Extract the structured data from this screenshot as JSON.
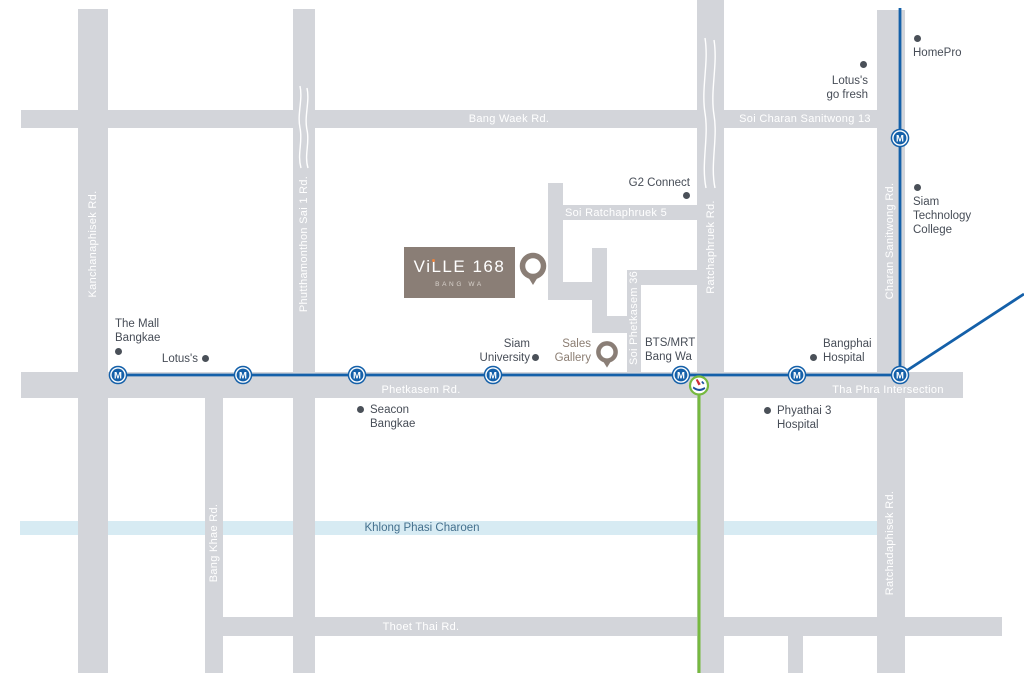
{
  "colors": {
    "road": "#d3d5da",
    "canal_fill": "#d7ebf3",
    "canal_text": "#44708d",
    "mrt_blue": "#1460a9",
    "bts_green": "#76b93f",
    "poi_text": "#474d57",
    "road_label": "#ffffff",
    "brand_taupe": "#8a7e76",
    "brand_subtitle": "#d8d2cc",
    "orange_accent": "#e8813c",
    "bts_logo_red": "#cf2e36",
    "bts_logo_blue": "#1d4f9e"
  },
  "logo": {
    "title": "ViLLE 168",
    "subtitle": "BANG WA",
    "x": 404,
    "y": 247,
    "w": 111,
    "h": 51
  },
  "project_pin": {
    "x": 533,
    "y": 266
  },
  "canal": {
    "label": "Khlong Phasi Charoen",
    "x": 20,
    "y": 521,
    "w": 857,
    "h": 14,
    "label_x": 422,
    "label_y": 528
  },
  "roads": [
    {
      "name": "kanchanaphisek-rd",
      "x": 78,
      "y": 9,
      "w": 30,
      "h": 664
    },
    {
      "name": "phutthamonthon-sai-1-rd",
      "x": 293,
      "y": 9,
      "w": 22,
      "h": 664
    },
    {
      "name": "ratchaphruek-rd",
      "x": 697,
      "y": 0,
      "w": 27,
      "h": 673
    },
    {
      "name": "charan-ratchadaphisek-rd",
      "x": 877,
      "y": 10,
      "w": 28,
      "h": 663
    },
    {
      "name": "bang-khae-rd",
      "x": 205,
      "y": 398,
      "w": 18,
      "h": 275
    },
    {
      "name": "south-stub",
      "x": 788,
      "y": 636,
      "w": 15,
      "h": 37
    },
    {
      "name": "bang-waek-soi-charan-13",
      "x": 21,
      "y": 110,
      "w": 856,
      "h": 18
    },
    {
      "name": "phetkasem-rd",
      "x": 21,
      "y": 372,
      "w": 942,
      "h": 26
    },
    {
      "name": "thoet-thai-rd",
      "x": 223,
      "y": 617,
      "w": 779,
      "h": 19
    },
    {
      "name": "soi-ratchaphruek-5",
      "x": 548,
      "y": 205,
      "w": 149,
      "h": 15
    },
    {
      "name": "soi-vertical-a",
      "x": 548,
      "y": 183,
      "w": 15,
      "h": 117
    },
    {
      "name": "soi-jog-1",
      "x": 548,
      "y": 282,
      "w": 59,
      "h": 18
    },
    {
      "name": "soi-vertical-b",
      "x": 592,
      "y": 248,
      "w": 15,
      "h": 85
    },
    {
      "name": "soi-jog-2",
      "x": 592,
      "y": 316,
      "w": 49,
      "h": 17
    },
    {
      "name": "soi-phetkasem-36",
      "x": 627,
      "y": 270,
      "w": 14,
      "h": 102
    },
    {
      "name": "soi-36-connector",
      "x": 627,
      "y": 270,
      "w": 70,
      "h": 15
    }
  ],
  "road_labels": [
    {
      "text": "Bang Waek Rd.",
      "x": 509,
      "y": 119,
      "rot": false
    },
    {
      "text": "Soi Charan Sanitwong 13",
      "x": 805,
      "y": 119,
      "rot": false
    },
    {
      "text": "Phetkasem Rd.",
      "x": 421,
      "y": 390,
      "rot": false
    },
    {
      "text": "Tha Phra Intersection",
      "x": 888,
      "y": 390,
      "rot": false
    },
    {
      "text": "Thoet Thai Rd.",
      "x": 421,
      "y": 627,
      "rot": false
    },
    {
      "text": "Soi Ratchaphruek 5",
      "x": 616,
      "y": 213,
      "rot": false
    },
    {
      "text": "Kanchanaphisek Rd.",
      "x": 93,
      "y": 244,
      "rot": true
    },
    {
      "text": "Phutthamonthon Sai 1 Rd.",
      "x": 304,
      "y": 244,
      "rot": true
    },
    {
      "text": "Soi Phetkasem 36",
      "x": 634,
      "y": 318,
      "rot": true
    },
    {
      "text": "Ratchaphruek Rd.",
      "x": 711,
      "y": 247,
      "rot": true
    },
    {
      "text": "Charan Sanitwong Rd.",
      "x": 890,
      "y": 241,
      "rot": true
    },
    {
      "text": "Bang Khae Rd.",
      "x": 214,
      "y": 543,
      "rot": true
    },
    {
      "text": "Ratchadaphisek Rd.",
      "x": 890,
      "y": 543,
      "rot": true
    }
  ],
  "pois": [
    {
      "name": "homepro",
      "lines": [
        "HomePro"
      ],
      "dot": [
        917,
        38
      ],
      "text_x": 913,
      "text_y": 46,
      "align": "left"
    },
    {
      "name": "lotuss-go-fresh",
      "lines": [
        "Lotus's",
        "go fresh"
      ],
      "dot": [
        863,
        64
      ],
      "text_x": 868,
      "text_y": 74,
      "align": "right"
    },
    {
      "name": "siam-technology-college",
      "lines": [
        "Siam",
        "Technology",
        "College"
      ],
      "dot": [
        917,
        187
      ],
      "text_x": 913,
      "text_y": 195,
      "align": "left"
    },
    {
      "name": "g2-connect",
      "lines": [
        "G2 Connect"
      ],
      "dot": [
        686,
        195
      ],
      "text_x": 690,
      "text_y": 176,
      "align": "right"
    },
    {
      "name": "the-mall-bangkae",
      "lines": [
        "The Mall",
        "Bangkae"
      ],
      "dot": [
        118,
        351
      ],
      "text_x": 115,
      "text_y": 317,
      "align": "left"
    },
    {
      "name": "lotuss",
      "lines": [
        "Lotus's"
      ],
      "dot": [
        205,
        358
      ],
      "text_x": 198,
      "text_y": 352,
      "align": "right"
    },
    {
      "name": "siam-university",
      "lines": [
        "Siam",
        "University"
      ],
      "dot": [
        535,
        357
      ],
      "text_x": 530,
      "text_y": 337,
      "align": "right"
    },
    {
      "name": "seacon-bangkae",
      "lines": [
        "Seacon",
        "Bangkae"
      ],
      "dot": [
        360,
        409
      ],
      "text_x": 370,
      "text_y": 403,
      "align": "left"
    },
    {
      "name": "bangphai-hospital",
      "lines": [
        "Bangphai",
        "Hospital"
      ],
      "dot": [
        813,
        357
      ],
      "text_x": 823,
      "text_y": 337,
      "align": "left"
    },
    {
      "name": "phyathai-3-hospital",
      "lines": [
        "Phyathai 3",
        "Hospital"
      ],
      "dot": [
        767,
        410
      ],
      "text_x": 777,
      "text_y": 404,
      "align": "left"
    },
    {
      "name": "bts-mrt-bang-wa",
      "lines": [
        "BTS/MRT",
        "Bang Wa"
      ],
      "dot": null,
      "text_x": 645,
      "text_y": 336,
      "align": "left"
    },
    {
      "name": "sales-gallery",
      "lines": [
        "Sales",
        "Gallery"
      ],
      "dot": null,
      "text_x": 591,
      "text_y": 337,
      "align": "right",
      "brand": true,
      "pin": [
        607,
        352
      ]
    }
  ],
  "transit": {
    "station_letter": "M",
    "mrt_stations": [
      [
        118,
        375
      ],
      [
        243,
        375
      ],
      [
        357,
        375
      ],
      [
        493,
        375
      ],
      [
        681,
        375
      ],
      [
        797,
        375
      ],
      [
        900,
        375
      ],
      [
        900,
        138
      ]
    ],
    "mrt_line": {
      "h_x1": 118,
      "h_x2": 900,
      "h_y": 375,
      "v_x": 900,
      "v_y1": 8,
      "diag_x2": 1024,
      "diag_y2": 294
    },
    "bts": {
      "cx": 699,
      "cy": 385.5,
      "line_y2": 673
    }
  },
  "canal_marks": [
    "M300,86 c3,14 -3,28 0,42 c3,14 -3,26 1,40",
    "M307,88 c3,14 -3,28 0,42 c3,13 -3,25 1,38",
    "M705,38 c4,25 -4,50 0,75 c4,25 -4,50 1,75",
    "M714,40 c4,25 -4,50 0,75 c4,24 -4,49 1,73"
  ]
}
